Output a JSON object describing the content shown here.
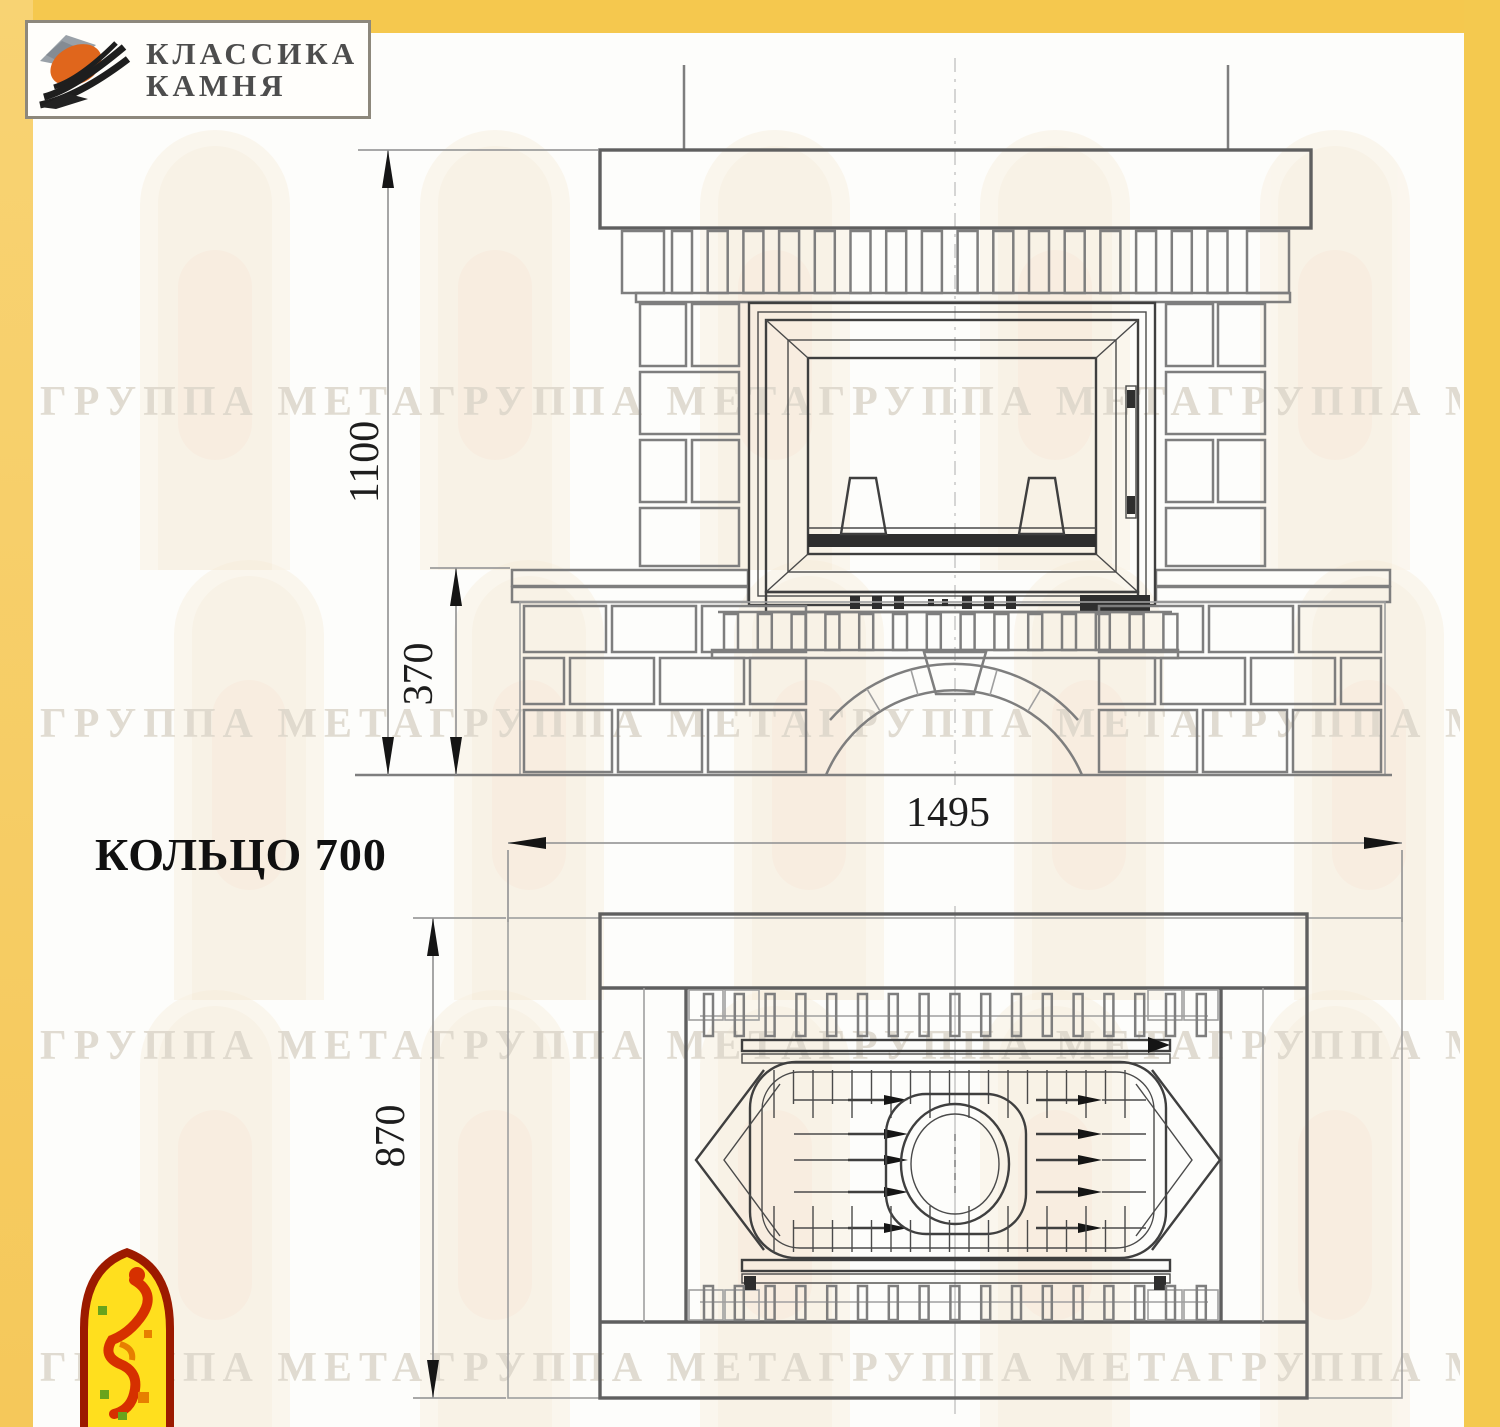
{
  "brand": {
    "name_line1": "КЛАССИКА",
    "name_line2": "КАМНЯ",
    "icon": "stone-brand-icon"
  },
  "model": {
    "title": "КОЛЬЦО 700"
  },
  "watermark": {
    "tiled_text": "ГРУППА МЕТАГРУППА МЕТАГРУППА МЕТАГРУППА МЕТА"
  },
  "drawing": {
    "views": {
      "front": "front elevation of fireplace",
      "plan": "top plan of fireplace"
    },
    "dimensions_mm": {
      "overall_height": "1100",
      "plinth_height": "370",
      "overall_width": "1495",
      "overall_depth": "870"
    },
    "colors": {
      "page_border_yellow": "#f5c84e",
      "drawing_line": "#7e7e7e",
      "dark_accent": "#1d1d1d",
      "logo_orange": "#e0661c",
      "mascot_red": "#d63000"
    }
  }
}
